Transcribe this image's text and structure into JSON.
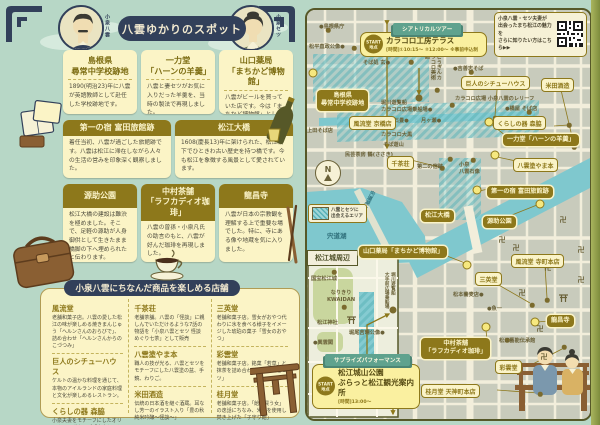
{
  "header": {
    "title": "八雲ゆかりのスポット",
    "portrait_left_name": "小泉八雲",
    "portrait_right_name": "小泉セツ"
  },
  "spots": [
    {
      "title": "島根県\n尋常中学校跡地",
      "desc": "1890(明治23)年に八雲が英語教師として赴任した学校跡地です。"
    },
    {
      "title": "一力堂\n「ハーンの羊羹」",
      "desc": "八雲と妻セツがお気に入りだった羊羹を、当時の製法で再現しました。"
    },
    {
      "title": "山口薬局\n「まちかど博物館」",
      "desc": "八雲がビールを買っていた店です。今は「まちかど博物館」としてレトロな品々が展示されています。"
    },
    {
      "title": "第一の宿 富田旅館跡",
      "desc": "着任当初、八雲が過ごした旅館跡です。八雲は松江に滞在しながら人々の生活の営みを印象深く観察しました。"
    },
    {
      "title": "松江大橋",
      "desc": "1608(慶長13)年に架けられた、松江城下でひときわ古い歴史を持つ橋です。今も松江を象徴する風景として愛されています。"
    },
    {
      "title": "源助公園",
      "desc": "松江大橋の建設は難渋を極めました。そこで、足軽の源助が人身御供として生きたまま橋脚の下へ埋められたと伝わります。"
    },
    {
      "title": "中村茶舗\n「ラフカディオ珈琲」",
      "desc": "八雲の曾孫・小泉凡氏の助言のもと、八雲が好んだ珈琲を再現しました。"
    },
    {
      "title": "龍昌寺",
      "desc": "八雲が日本の宗教観を理解する上で重要な場でした。特に、寺にある像や地蔵を気に入りました。"
    }
  ],
  "stores_section": {
    "title": "小泉八雲にちなんだ商品を楽しめる店舗",
    "stores": [
      {
        "name": "風流堂",
        "desc": "老舗和菓子店。八雲の愛した松江の味が楽しめる焼きまんじゅう「ヘルンさんのおらびで」、詰め合わせ「ヘルンさんからのこづつみ」"
      },
      {
        "name": "巨人のシチューハウス",
        "desc": "ケルトの温かな料理を通じて、本物のアイルランドの家庭料理と文化が楽しめるレストラン。"
      },
      {
        "name": "くらしの器 森脇",
        "desc": "小泉夫妻をモチーフにしたオリジナルマグカップ「小泉セツとラフカディオ・ハーン」"
      },
      {
        "name": "千茶荘",
        "desc": "老舗茶舗。八雲の「怪談」に親しんでいただけるような7話の物語を「小泉八雲とセツ 怪談めぐり七茶」として販売"
      },
      {
        "name": "八雲塗やま本",
        "desc": "職人の技が光る、八雲とセツをモチーフにした八雲塗の盆、手鏡、わりご。"
      },
      {
        "name": "米田酒造",
        "desc": "伝統の日本酒を継ぐ酒蔵。耳なし芳一のイラスト入り「豊の秋 純米吟醸〜怪談〜」"
      },
      {
        "name": "三英堂",
        "desc": "老舗和菓子店。雪女がおやつ代わりに氷を食べる様子をイメージした琥珀の菓子「雪女のおやつ」"
      },
      {
        "name": "彩雲堂",
        "desc": "老舗和菓子店。銘菓「若草」と抹茶を詰め合わせた「八雲とセツ」"
      },
      {
        "name": "桂月堂",
        "desc": "老舗和菓子店。「飴を買う女」の逸話にちなみ、米飴を使用し焚き上げた「子守り飴」"
      }
    ]
  },
  "map": {
    "qr_note": "小泉八雲・セツ夫妻が\n出会ったまち松江の魅力を\nさらに知りたい方はこちら▶▶",
    "legend_text": "八雲とセツに\n出会えるエリア",
    "inset_title": "松江城周辺",
    "compass_label": "N",
    "temple_mark": "卍",
    "tours": [
      {
        "ribbon": "シアトリカルツアー",
        "badge": "START\n地点",
        "name": "カラコロ工房テラス",
        "time": "[時間]①10:15〜 ②12:00〜 ※事前申込制"
      },
      {
        "ribbon": "サプライズパフォーマンス",
        "badge": "START\n地点",
        "name": "松江城山公園\nぶらっと松江観光案内所",
        "time": "[時間]13:00〜"
      }
    ],
    "spot_labels": [
      {
        "text": "島根県\n尋常中学校跡地"
      },
      {
        "text": "山口薬局「まちかど博物館」"
      },
      {
        "text": "一力堂「ハーンの羊羹」"
      },
      {
        "text": "第一の宿 富田旅館跡"
      },
      {
        "text": "松江大橋"
      },
      {
        "text": "源助公園"
      },
      {
        "text": "中村茶舗\n「ラフカディオ珈琲」"
      },
      {
        "text": "龍昌寺"
      }
    ],
    "store_labels": [
      {
        "text": "巨人のシチューハウス"
      },
      {
        "text": "米田酒造"
      },
      {
        "text": "風流堂 京橋店"
      },
      {
        "text": "くらしの器 森脇"
      },
      {
        "text": "千茶荘"
      },
      {
        "text": "八雲塗やま本"
      },
      {
        "text": "風流堂 寺町本店"
      },
      {
        "text": "三英堂"
      },
      {
        "text": "彩雲堂"
      },
      {
        "text": "桂月堂 天神町本店"
      }
    ],
    "poi_labels": [
      {
        "text": "●島根県庁"
      },
      {
        "text": "松平直政公像●"
      },
      {
        "text": "そば処 玄●"
      },
      {
        "text": "ごうぎんカラコロ美術館"
      },
      {
        "text": "●吉善志そば"
      },
      {
        "text": "カラコロ広場 小泉八雲のレリーフ"
      },
      {
        "text": "●橋屋 そば店"
      },
      {
        "text": "上田そば店"
      },
      {
        "text": "堀川遊覧船\nカラコロ広場乗船場●"
      },
      {
        "text": "ハートの石畳●"
      },
      {
        "text": "月ヶ瀬●"
      },
      {
        "text": "カラコロ大黒"
      },
      {
        "text": "そば遊山"
      },
      {
        "text": "民芸茶房 鶴(ささき)"
      },
      {
        "text": "第二の宿跡"
      },
      {
        "text": "小泉\n八雲石像"
      },
      {
        "text": "宍道湖"
      },
      {
        "text": "宍道湖大橋"
      },
      {
        "text": "●魚一"
      },
      {
        "text": "松本蕎麦店●"
      },
      {
        "text": "松江藝能伝承館"
      },
      {
        "text": "国宝松江城"
      },
      {
        "text": "なりきり\nKWAIDAN"
      },
      {
        "text": "●興雲閣"
      },
      {
        "text": "松江神社"
      },
      {
        "text": "堀尾吉晴公像●"
      },
      {
        "text": "堀川遊覧船\n大手前広場乗船場"
      },
      {
        "text": "●島根県庁"
      }
    ],
    "markers": {
      "yellow": [
        [
          6,
          63
        ],
        [
          182,
          112
        ],
        [
          188,
          145
        ],
        [
          170,
          180
        ],
        [
          160,
          255
        ],
        [
          233,
          194
        ],
        [
          179,
          317
        ],
        [
          228,
          312
        ]
      ],
      "olive": [
        [
          21,
          20
        ],
        [
          47,
          38
        ],
        [
          104,
          52
        ],
        [
          130,
          80
        ],
        [
          164,
          62
        ],
        [
          222,
          102
        ],
        [
          267,
          137
        ],
        [
          188,
          108
        ],
        [
          145,
          95
        ],
        [
          262,
          115
        ],
        [
          135,
          158
        ],
        [
          143,
          149
        ],
        [
          166,
          150
        ],
        [
          240,
          290
        ],
        [
          225,
          295
        ],
        [
          257,
          337
        ],
        [
          233,
          384
        ],
        [
          200,
          330
        ],
        [
          27,
          262
        ],
        [
          37,
          297
        ],
        [
          86,
          390
        ]
      ],
      "start": [
        [
          112,
          88
        ],
        [
          86,
          300
        ]
      ]
    },
    "temples": [
      [
        195,
        230
      ],
      [
        209,
        238
      ],
      [
        241,
        258
      ],
      [
        215,
        283
      ],
      [
        274,
        240
      ],
      [
        274,
        270
      ],
      [
        233,
        319
      ],
      [
        237,
        347
      ],
      [
        256,
        210
      ]
    ]
  }
}
